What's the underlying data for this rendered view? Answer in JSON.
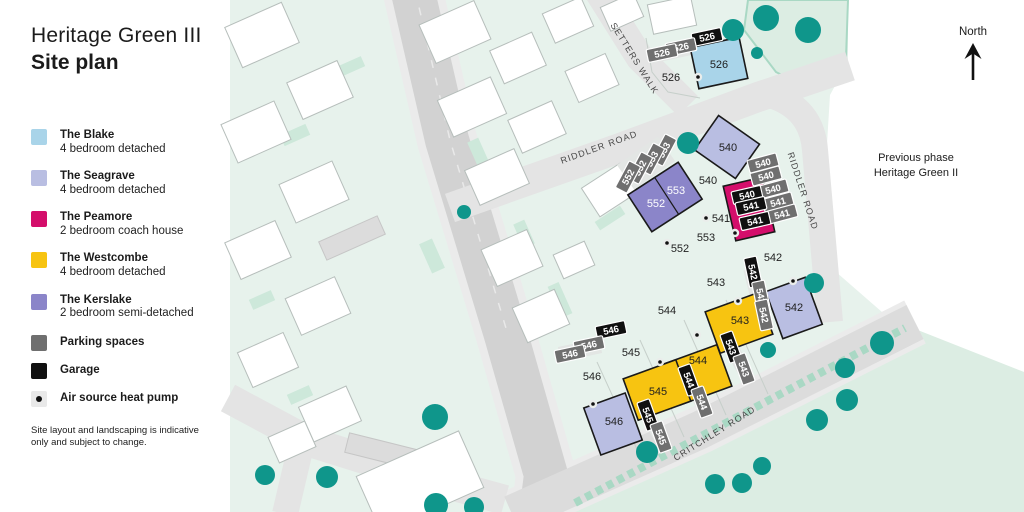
{
  "header": {
    "title_line1": "Heritage Green III",
    "title_line2": "Site plan"
  },
  "legend": {
    "items": [
      {
        "name": "The Blake",
        "desc": "4 bedroom detached",
        "color": "#a9d4e9",
        "type": "swatch"
      },
      {
        "name": "The Seagrave",
        "desc": "4 bedroom detached",
        "color": "#b9bee2",
        "type": "swatch"
      },
      {
        "name": "The Peamore",
        "desc": "2 bedroom coach house",
        "color": "#d40e6b",
        "type": "swatch"
      },
      {
        "name": "The Westcombe",
        "desc": "4 bedroom detached",
        "color": "#f7c411",
        "type": "swatch"
      },
      {
        "name": "The Kerslake",
        "desc": "2 bedroom semi-detached",
        "color": "#8b85c9",
        "type": "swatch"
      },
      {
        "name": "Parking spaces",
        "desc": "",
        "color": "#6f6f6f",
        "type": "swatch"
      },
      {
        "name": "Garage",
        "desc": "",
        "color": "#101010",
        "type": "swatch"
      },
      {
        "name": "Air source heat pump",
        "desc": "",
        "color": "#111111",
        "type": "dot"
      }
    ]
  },
  "disclaimer": "Site layout and landscaping is indicative only and subject to change.",
  "annotations": {
    "north_label": "North",
    "previous_phase_line1": "Previous phase",
    "previous_phase_line2": "Heritage Green II"
  },
  "map": {
    "colors": {
      "base": "#e7f2ec",
      "green_area": "#dcede3",
      "hedge": "#a9d8c4",
      "road_main": "#d2d2d2",
      "road_light": "#e4e4e4",
      "road_pave": "#ebebeb",
      "critchley": "#dcdcdc",
      "building": "#ffffff",
      "building_stroke": "#b6bebb",
      "parcel_line": "#c6cfca",
      "tree": "#0f968b",
      "garden": "#cde8da",
      "driveway": "#e3e6e4",
      "house_stroke": "#1a1a1a",
      "blake": "#a9d4e9",
      "seagrave": "#b9bee2",
      "peamore": "#d40e6b",
      "westcombe": "#f7c411",
      "kerslake": "#8b85c9",
      "parking": "#6f6f6f",
      "garage": "#101010",
      "label": "#1f1f1f",
      "road_label": "#474747"
    },
    "base_polygon": "230,0 848,0 848,62 830,95 820,258 898,326 1024,372 1024,512 230,512",
    "landscape_polygon": "748,0 848,0 846,58 815,92 776,72 744,30",
    "green_polygon": "560,512 905,325 1024,372 1024,512",
    "hedge_path": "M575,503 L905,328",
    "roads": [
      {
        "name": "main-road-pavement",
        "d": "M412,-12 L447,140 L506,335 L546,475 L541,514",
        "color": "#ebebeb",
        "width": 60
      },
      {
        "name": "critchley-road-pavement",
        "d": "M512,514 L700,430 L915,322",
        "color": "#ebebeb",
        "width": 48
      },
      {
        "name": "main-road",
        "d": "M412,-12 L447,140 L506,335 L546,475 L541,514",
        "color": "#d2d2d2",
        "width": 44
      },
      {
        "name": "main-road-centerline",
        "d": "M415,-10 L450,140 L508,335",
        "color": "#e9e9e9",
        "width": 1.5,
        "dash": "8 10"
      },
      {
        "name": "bottom-left-road",
        "d": "M228,398 L310,442 L425,478 L505,500",
        "color": "#e4e4e4",
        "width": 30
      },
      {
        "name": "bottom-left-stub",
        "d": "M300,450 L285,514",
        "color": "#e4e4e4",
        "width": 26
      },
      {
        "name": "setters-walk-road",
        "d": "M596,-12 L640,58 L688,106",
        "color": "#e4e4e4",
        "width": 28
      },
      {
        "name": "riddler-road-top",
        "d": "M450,208 L620,148 L758,97 L850,66",
        "color": "#e4e4e4",
        "width": 30
      },
      {
        "name": "riddler-road-right",
        "d": "M770,95 Q812,108 815,150 L830,322",
        "color": "#e4e4e4",
        "width": 26
      },
      {
        "name": "critchley-road",
        "d": "M512,514 L700,430 L915,322",
        "color": "#dcdcdc",
        "width": 38
      }
    ],
    "parcel_lines": [
      "641,458 597,362",
      "684,437 640,340",
      "726,415 684,320",
      "768,394 726,300",
      "646,38 652,72 668,92 700,98"
    ],
    "gardens": [
      [
        295,
        135,
        28,
        12,
        -24
      ],
      [
        352,
        66,
        24,
        11,
        -24
      ],
      [
        262,
        300,
        24,
        11,
        -24
      ],
      [
        432,
        256,
        14,
        32,
        -24
      ],
      [
        524,
        234,
        12,
        26,
        -24
      ],
      [
        560,
        300,
        12,
        34,
        -24
      ],
      [
        300,
        395,
        24,
        11,
        -24
      ],
      [
        478,
        152,
        12,
        26,
        -24
      ],
      [
        610,
        218,
        30,
        10,
        -33
      ]
    ],
    "parking_strips": [
      [
        352,
        238,
        64,
        20,
        -24
      ],
      [
        385,
        452,
        78,
        20,
        14
      ]
    ],
    "bg_buildings": [
      [
        262,
        35,
        62,
        44,
        -24
      ],
      [
        320,
        90,
        55,
        40,
        -24
      ],
      [
        256,
        132,
        58,
        42,
        -24
      ],
      [
        314,
        192,
        58,
        42,
        -24
      ],
      [
        258,
        250,
        55,
        40,
        -24
      ],
      [
        318,
        306,
        54,
        40,
        -24
      ],
      [
        268,
        360,
        50,
        38,
        -24
      ],
      [
        330,
        414,
        52,
        38,
        -24
      ],
      [
        455,
        32,
        60,
        42,
        -24
      ],
      [
        518,
        58,
        46,
        36,
        -24
      ],
      [
        472,
        107,
        58,
        40,
        -24
      ],
      [
        537,
        127,
        48,
        36,
        -24
      ],
      [
        497,
        177,
        54,
        38,
        -24
      ],
      [
        568,
        20,
        42,
        32,
        -24
      ],
      [
        592,
        78,
        44,
        34,
        -24
      ],
      [
        622,
        12,
        36,
        26,
        -24
      ],
      [
        672,
        15,
        44,
        30,
        -12
      ],
      [
        610,
        190,
        46,
        34,
        -33
      ],
      [
        512,
        258,
        50,
        40,
        -24
      ],
      [
        541,
        316,
        46,
        38,
        -24
      ],
      [
        574,
        260,
        34,
        26,
        -24
      ],
      [
        292,
        442,
        40,
        28,
        -24
      ],
      [
        420,
        482,
        112,
        62,
        -24
      ]
    ],
    "driveways": [
      [
        672,
        52,
        46,
        14,
        -12
      ],
      [
        646,
        163,
        50,
        30,
        -35
      ],
      [
        772,
        188,
        16,
        58,
        -20
      ],
      [
        757,
        294,
        15,
        52,
        -14
      ],
      [
        737,
        358,
        14,
        40,
        -30
      ],
      [
        695,
        391,
        14,
        40,
        -30
      ],
      [
        654,
        426,
        14,
        40,
        -30
      ],
      [
        580,
        350,
        42,
        15,
        -12
      ]
    ],
    "houses": [
      {
        "plot": "526",
        "type": "blake",
        "cx": 719,
        "cy": 63,
        "w": 50,
        "h": 42,
        "rot": -12
      },
      {
        "plot": "540",
        "type": "seagrave",
        "cx": 727,
        "cy": 147,
        "w": 50,
        "h": 42,
        "rot": 35
      },
      {
        "plot": "552-553",
        "type": "kerslake",
        "cx": 665,
        "cy": 197,
        "w": 60,
        "h": 44,
        "rot": -33,
        "divider": 2
      },
      {
        "plot": "540-541",
        "type": "peamore",
        "cx": 749,
        "cy": 209,
        "w": 40,
        "h": 56,
        "rot": -13
      },
      {
        "plot": "542",
        "type": "seagrave",
        "cx": 794,
        "cy": 308,
        "w": 42,
        "h": 50,
        "rot": -20
      },
      {
        "plot": "543",
        "type": "westcombe",
        "cx": 739,
        "cy": 323,
        "w": 56,
        "h": 44,
        "rot": -20
      },
      {
        "plot": "544",
        "type": "westcombe",
        "cx": 698,
        "cy": 375,
        "w": 56,
        "h": 44,
        "rot": -20
      },
      {
        "plot": "545",
        "type": "westcombe",
        "cx": 657,
        "cy": 390,
        "w": 56,
        "h": 44,
        "rot": -20
      },
      {
        "plot": "546",
        "type": "seagrave",
        "cx": 613,
        "cy": 424,
        "w": 44,
        "h": 50,
        "rot": -20
      }
    ],
    "chips": [
      {
        "text": "526",
        "kind": "garage",
        "x": 707,
        "y": 37,
        "rot": -12
      },
      {
        "text": "526",
        "kind": "parking",
        "x": 681,
        "y": 47,
        "rot": -12
      },
      {
        "text": "526",
        "kind": "parking",
        "x": 662,
        "y": 53,
        "rot": -12
      },
      {
        "text": "553",
        "kind": "parking",
        "x": 664,
        "y": 150,
        "rot": -62
      },
      {
        "text": "553",
        "kind": "parking",
        "x": 652,
        "y": 159,
        "rot": -62
      },
      {
        "text": "552",
        "kind": "parking",
        "x": 640,
        "y": 168,
        "rot": -62
      },
      {
        "text": "552",
        "kind": "parking",
        "x": 628,
        "y": 177,
        "rot": -62
      },
      {
        "text": "540",
        "kind": "parking",
        "x": 763,
        "y": 163,
        "rot": -15
      },
      {
        "text": "540",
        "kind": "parking",
        "x": 766,
        "y": 176,
        "rot": -15
      },
      {
        "text": "540",
        "kind": "parking",
        "x": 773,
        "y": 189,
        "rot": -15
      },
      {
        "text": "541",
        "kind": "parking",
        "x": 778,
        "y": 202,
        "rot": -15
      },
      {
        "text": "541",
        "kind": "parking",
        "x": 782,
        "y": 214,
        "rot": -15
      },
      {
        "text": "540",
        "kind": "garage",
        "x": 747,
        "y": 195,
        "rot": -13
      },
      {
        "text": "541",
        "kind": "garage",
        "x": 751,
        "y": 206,
        "rot": -13
      },
      {
        "text": "541",
        "kind": "garage",
        "x": 755,
        "y": 221,
        "rot": -13
      },
      {
        "text": "542",
        "kind": "garage",
        "x": 753,
        "y": 272,
        "rot": 78
      },
      {
        "text": "542",
        "kind": "parking",
        "x": 761,
        "y": 296,
        "rot": 78
      },
      {
        "text": "542",
        "kind": "parking",
        "x": 764,
        "y": 315,
        "rot": 78
      },
      {
        "text": "543",
        "kind": "garage",
        "x": 731,
        "y": 347,
        "rot": 70
      },
      {
        "text": "543",
        "kind": "parking",
        "x": 744,
        "y": 369,
        "rot": 70
      },
      {
        "text": "544",
        "kind": "garage",
        "x": 689,
        "y": 380,
        "rot": 70
      },
      {
        "text": "544",
        "kind": "parking",
        "x": 702,
        "y": 402,
        "rot": 70
      },
      {
        "text": "545",
        "kind": "garage",
        "x": 648,
        "y": 415,
        "rot": 70
      },
      {
        "text": "545",
        "kind": "parking",
        "x": 661,
        "y": 437,
        "rot": 70
      },
      {
        "text": "546",
        "kind": "garage",
        "x": 611,
        "y": 330,
        "rot": -12
      },
      {
        "text": "546",
        "kind": "parking",
        "x": 589,
        "y": 345,
        "rot": -12
      },
      {
        "text": "546",
        "kind": "parking",
        "x": 570,
        "y": 354,
        "rot": -12
      }
    ],
    "labels": [
      {
        "text": "526",
        "x": 719,
        "y": 68,
        "name": "house-label-526"
      },
      {
        "text": "540",
        "x": 728,
        "y": 151,
        "name": "house-label-540"
      },
      {
        "text": "552",
        "x": 656,
        "y": 207,
        "color": "#ffffff",
        "name": "house-label-552"
      },
      {
        "text": "553",
        "x": 676,
        "y": 194,
        "color": "#ffffff",
        "name": "house-label-553"
      },
      {
        "text": "542",
        "x": 794,
        "y": 311,
        "name": "house-label-542"
      },
      {
        "text": "543",
        "x": 740,
        "y": 324,
        "name": "house-label-543"
      },
      {
        "text": "544",
        "x": 698,
        "y": 364,
        "name": "house-label-544"
      },
      {
        "text": "545",
        "x": 658,
        "y": 395,
        "name": "house-label-545"
      },
      {
        "text": "546",
        "x": 614,
        "y": 425,
        "name": "house-label-546"
      },
      {
        "text": "526",
        "x": 671,
        "y": 81,
        "name": "plot-label-526"
      },
      {
        "text": "540",
        "x": 708,
        "y": 184,
        "name": "plot-label-540"
      },
      {
        "text": "541",
        "x": 721,
        "y": 222,
        "name": "plot-label-541"
      },
      {
        "text": "553",
        "x": 706,
        "y": 241,
        "name": "plot-label-553"
      },
      {
        "text": "552",
        "x": 680,
        "y": 252,
        "name": "plot-label-552"
      },
      {
        "text": "542",
        "x": 773,
        "y": 261,
        "name": "plot-label-542"
      },
      {
        "text": "543",
        "x": 716,
        "y": 286,
        "name": "plot-label-543"
      },
      {
        "text": "544",
        "x": 667,
        "y": 314,
        "name": "plot-label-544"
      },
      {
        "text": "545",
        "x": 631,
        "y": 356,
        "name": "plot-label-545"
      },
      {
        "text": "546",
        "x": 592,
        "y": 380,
        "name": "plot-label-546"
      }
    ],
    "road_labels": [
      {
        "text": "SETTERS WALK",
        "x": 632,
        "y": 60,
        "rot": 58
      },
      {
        "text": "RIDDLER ROAD",
        "x": 600,
        "y": 150,
        "rot": -20
      },
      {
        "text": "RIDDLER ROAD",
        "x": 800,
        "y": 192,
        "rot": 72
      },
      {
        "text": "CRITCHLEY ROAD",
        "x": 716,
        "y": 436,
        "rot": -32
      }
    ],
    "trees": [
      [
        733,
        30,
        11
      ],
      [
        766,
        18,
        13
      ],
      [
        808,
        30,
        13
      ],
      [
        757,
        53,
        6
      ],
      [
        688,
        143,
        11
      ],
      [
        464,
        212,
        7
      ],
      [
        265,
        475,
        10
      ],
      [
        327,
        477,
        11
      ],
      [
        435,
        417,
        13
      ],
      [
        436,
        505,
        12
      ],
      [
        474,
        507,
        10
      ],
      [
        768,
        350,
        8
      ],
      [
        814,
        283,
        10
      ],
      [
        647,
        452,
        11
      ],
      [
        715,
        484,
        10
      ],
      [
        742,
        483,
        10
      ],
      [
        762,
        466,
        9
      ],
      [
        817,
        420,
        11
      ],
      [
        847,
        400,
        11
      ],
      [
        845,
        368,
        10
      ],
      [
        882,
        343,
        12
      ]
    ],
    "heat_pumps": [
      [
        698,
        77
      ],
      [
        706,
        218
      ],
      [
        667,
        243
      ],
      [
        735,
        233
      ],
      [
        793,
        281
      ],
      [
        738,
        301
      ],
      [
        697,
        335
      ],
      [
        660,
        362
      ],
      [
        593,
        404
      ]
    ]
  }
}
